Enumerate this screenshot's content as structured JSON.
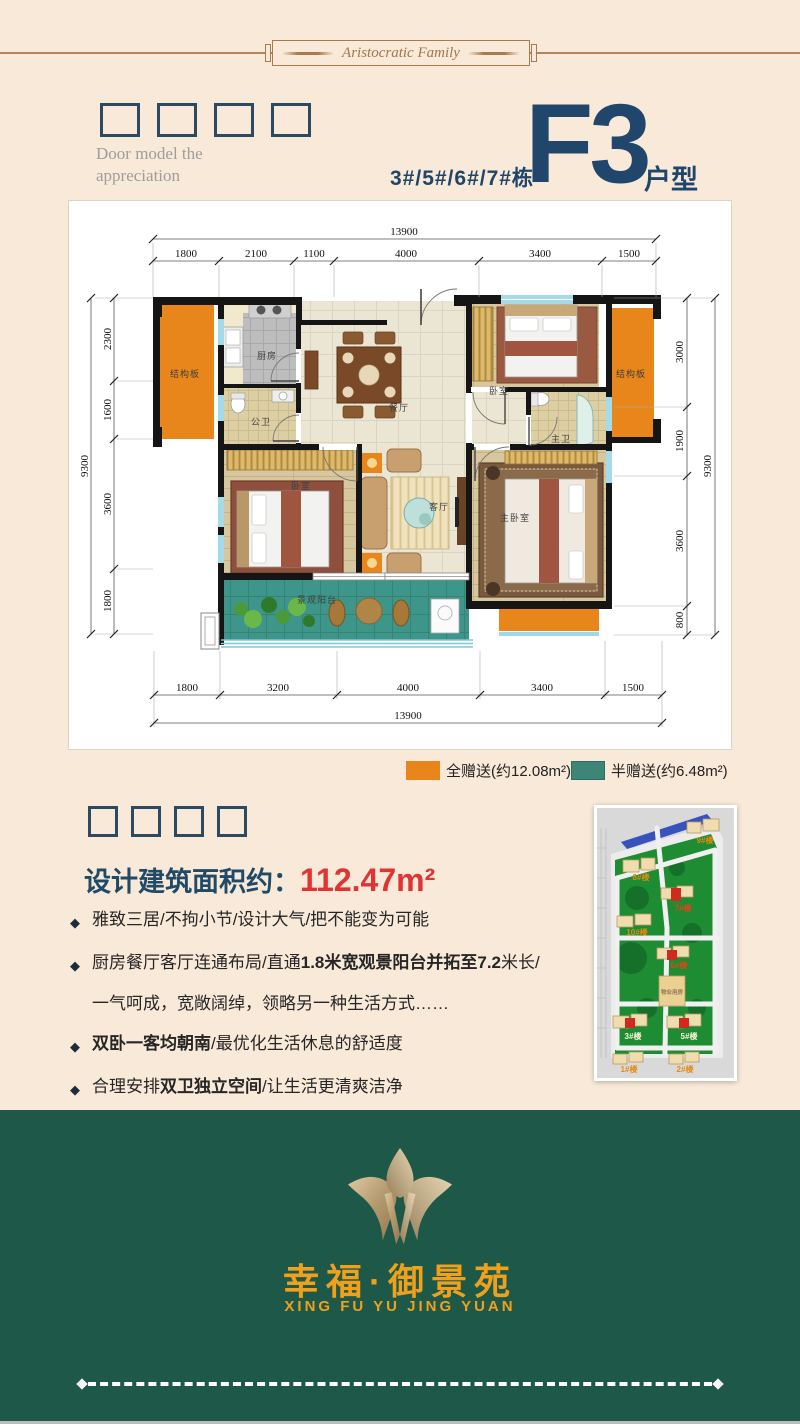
{
  "ornament": {
    "banner": "Aristocratic Family"
  },
  "header": {
    "caption_line1": "Door model the",
    "caption_line2": "appreciation",
    "buildings": "3#/5#/6#/7#栋",
    "model_code": "F3",
    "model_label": "户型",
    "model_sublabel": "door model"
  },
  "floorplan": {
    "dims": {
      "top_total": "13900",
      "top_segments": [
        "1800",
        "2100",
        "1100",
        "4000",
        "3400",
        "1500"
      ],
      "bottom_segments": [
        "1800",
        "3200",
        "4000",
        "3400",
        "1500"
      ],
      "bottom_total": "13900",
      "left_segments": [
        "2300",
        "1600",
        "3600",
        "1800"
      ],
      "left_total": "9300",
      "right_segments": [
        "3000",
        "1900",
        "3600",
        "800"
      ],
      "right_total": "9300"
    },
    "rooms": {
      "structural_left": "结构板",
      "kitchen": "厨房",
      "bath_public": "公卫",
      "bedroom_left": "卧室",
      "dining": "餐厅",
      "living": "客厅",
      "bedroom_right": "卧室",
      "bath_master": "主卫",
      "master_bedroom": "主卧室",
      "structural_right": "结构板",
      "balcony": "景观阳台"
    }
  },
  "legend": {
    "full_gift": {
      "label": "全赠送(约12.08m²)",
      "color": "#e8861c"
    },
    "half_gift": {
      "label": "半赠送(约6.48m²)",
      "color": "#3d8577"
    }
  },
  "details": {
    "area_label": "设计建筑面积约：",
    "area_value": "112.47m²",
    "bullet_icon": "◆",
    "features": [
      {
        "t1": "雅致三居/不拘小节/设计大气/把不能变为可能"
      },
      {
        "t1": "厨房餐厅客厅连通布局/直通",
        "bold": "1.8米宽观景阳台并拓至7.2",
        "t2": "米长/"
      },
      {
        "t1": "一气呵成，宽敞阔绰，领略另一种生活方式……"
      },
      {
        "bold": "双卧一客均朝南",
        "t2": "/最优化生活休息的舒适度"
      },
      {
        "t1": "合理安排",
        "bold": "双卫独立空间",
        "t2": "/让生活更清爽洁净"
      }
    ]
  },
  "sitemap": {
    "labels": [
      {
        "text": "9#楼",
        "color": "#e8890f"
      },
      {
        "text": "8#楼",
        "color": "#e8890f"
      },
      {
        "text": "7#楼",
        "color": "#e04518"
      },
      {
        "text": "10#楼",
        "color": "#e8890f"
      },
      {
        "text": "6#楼",
        "color": "#e04518"
      },
      {
        "text": "物业用房",
        "color": "#8a7a55"
      },
      {
        "text": "3#楼",
        "color": "#fdf3da"
      },
      {
        "text": "5#楼",
        "color": "#fdf3da"
      },
      {
        "text": "1#楼",
        "color": "#e8890f"
      },
      {
        "text": "2#楼",
        "color": "#e8890f"
      }
    ]
  },
  "footer": {
    "brand": "幸福·御景苑",
    "brand_pinyin": "XING FU YU JING YUAN"
  },
  "colors": {
    "background": "#f9e9d8",
    "navy": "#21466b",
    "accent_red": "#e13333",
    "orange_gift": "#e8861c",
    "teal_gift": "#3d8577",
    "footer_green": "#1e5848",
    "brand_gold": "#f0a11c"
  }
}
